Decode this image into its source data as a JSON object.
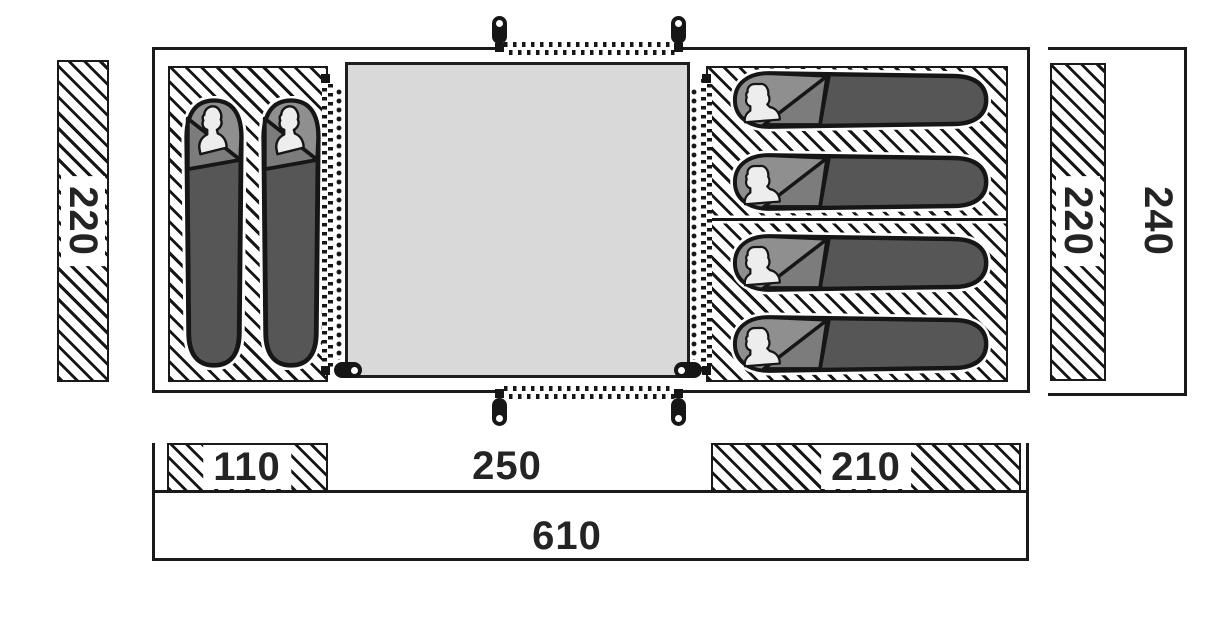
{
  "diagram_title": "Tent floor plan",
  "dimensions": {
    "left_strip_depth": "220",
    "right_strip_depth": "220",
    "outer_depth": "240",
    "left_bedroom_width": "110",
    "living_area_width": "250",
    "right_bedroom_width": "210",
    "total_width": "610"
  },
  "features": {
    "left_bedroom_sleeping_bags": 2,
    "right_bedroom_sleeping_bags": 4,
    "door_zippers": 4,
    "zipper_pulls": 6
  },
  "colors": {
    "line": "#1a1a1a",
    "groundsheet_fill": "#d9d9d9",
    "sleeping_bag_body": "#565656",
    "sleeping_bag_hood": "#8f8f8f",
    "sleeping_bag_flap": "#7c7c7c",
    "person_silhouette": "#ededed",
    "background": "#ffffff"
  }
}
